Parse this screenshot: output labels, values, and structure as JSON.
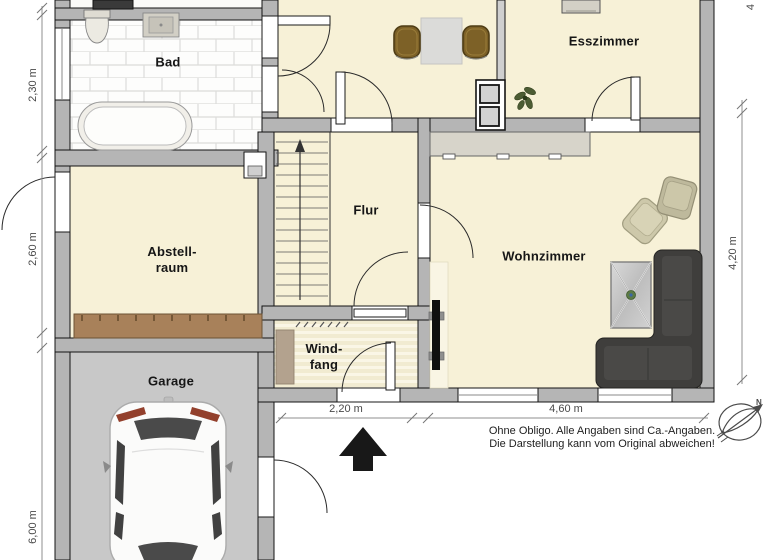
{
  "floorplan": {
    "title": "Erdgeschoss Grundriss",
    "room_labels": {
      "bad": "Bad",
      "esszimmer": "Esszimmer",
      "abstellraum_line1": "Abstell-",
      "abstellraum_line2": "raum",
      "flur": "Flur",
      "wohnzimmer": "Wohnzimmer",
      "windfang_line1": "Wind-",
      "windfang_line2": "fang",
      "garage": "Garage"
    },
    "dimensions": {
      "bad_left": "2,30 m",
      "abstellraum_left": "2,60 m",
      "garage_left": "6,00 m",
      "windfang_bottom": "2,20 m",
      "wohnzimmer_bottom": "4,60 m",
      "wohnzimmer_right": "4,20 m",
      "top_right_partial": "4"
    },
    "disclaimer": {
      "line1": "Ohne Obligo. Alle Angaben sind Ca.-Angaben.",
      "line2": "Die Darstellung kann vom Original abweichen!"
    },
    "compass_letter": "N",
    "icons": [
      "toilet-icon",
      "sink-icon",
      "bathtub-icon",
      "dining-table-icon",
      "dining-chair-icon",
      "chimney-shaft-icon",
      "stairs-icon",
      "stairs-arrow-icon",
      "plant-icon",
      "sideboard-icon",
      "armchair-icon",
      "coffee-table-icon",
      "corner-sofa-icon",
      "tv-icon",
      "coat-hooks-icon",
      "doormat-icon",
      "storage-shelf-icon",
      "car-icon",
      "entrance-arrow-icon",
      "north-compass-icon",
      "door-swing-icon",
      "window-icon"
    ],
    "colors": {
      "floor_cream": "#f7f1d7",
      "wall_gray": "#b5b5b5",
      "garage_floor": "#c8c8c8",
      "bath_tile_white": "#fdfdfc",
      "tile_grout": "#dcdcda",
      "shelf_brown": "#a8815a",
      "chair_brown": "#7d6127",
      "sofa_dark": "#3f3e3c",
      "armchair_sage": "#cdc8aa",
      "dimension_gray": "#8f8f8f",
      "arrow_black": "#181818"
    }
  }
}
